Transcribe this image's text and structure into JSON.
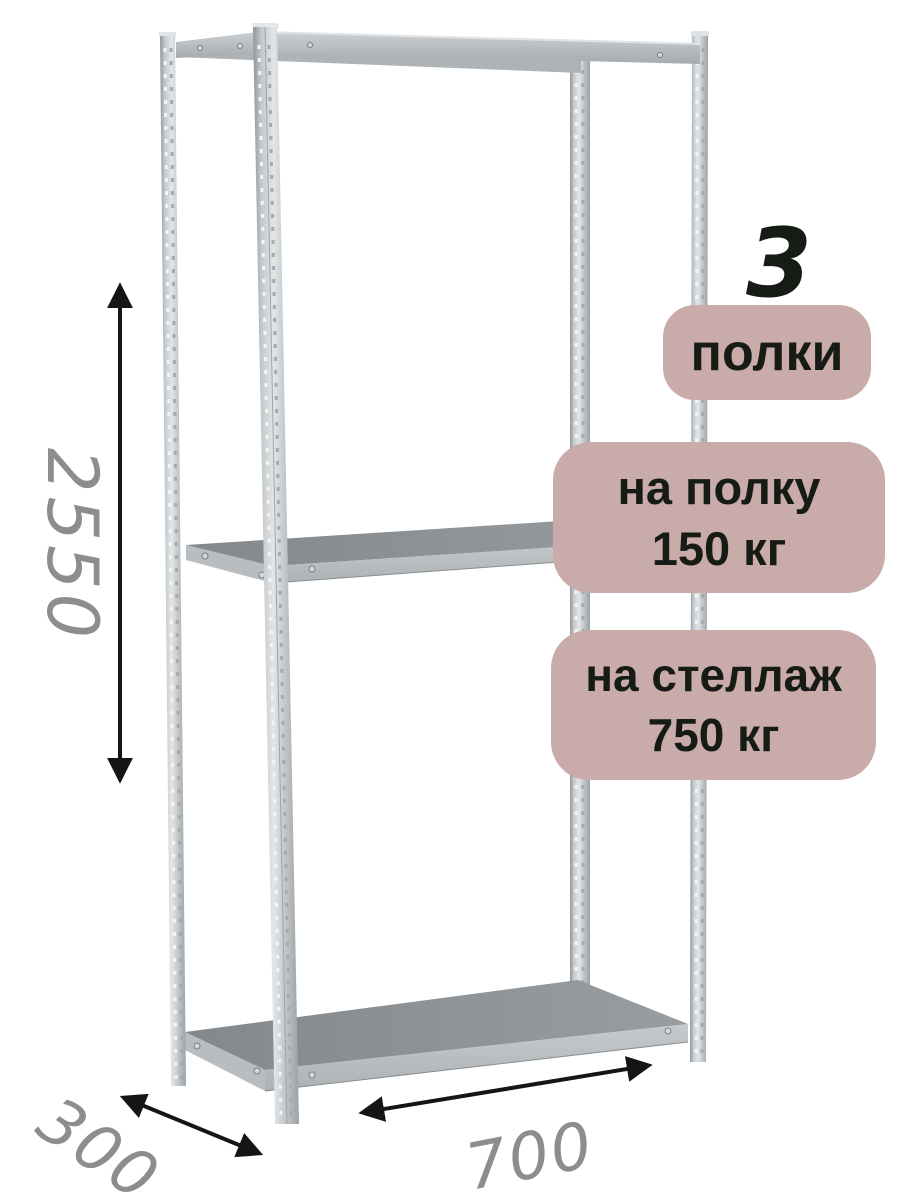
{
  "annotations": {
    "shelf_count": {
      "number": "3",
      "label": "полки"
    },
    "load_per_shelf": {
      "line1": "на полку",
      "line2": "150 кг"
    },
    "load_per_rack": {
      "line1": "на стеллаж",
      "line2": "750 кг"
    }
  },
  "dimensions": {
    "height": "2550",
    "depth": "300",
    "width": "700"
  },
  "colors": {
    "badge_bg": "#c9abaa",
    "badge_text": "#161b16",
    "dimension_text": "#8d8d8d",
    "arrow": "#151515",
    "metal_light": "#e3e6e8",
    "metal_mid": "#c0c5c8",
    "metal_dark": "#8f959a",
    "shelf_top": "#8b9095"
  }
}
